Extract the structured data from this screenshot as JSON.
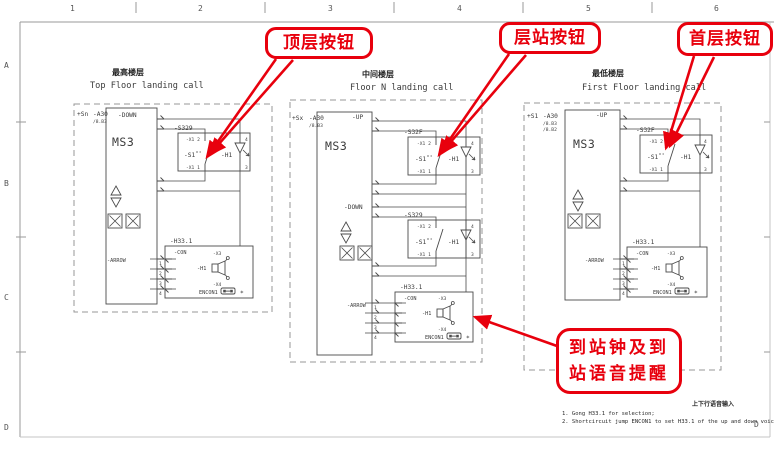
{
  "frame": {
    "cols": [
      "1",
      "2",
      "3",
      "4",
      "5",
      "6"
    ],
    "rowA": "A",
    "rowB": "B",
    "rowC": "C",
    "rowD": "D",
    "rowD_right": "D"
  },
  "callouts": {
    "top": "顶层按钮",
    "middle": "层站按钮",
    "first": "首层按钮",
    "arrival_l1": "到站钟及到",
    "arrival_l2": "站语音提醒"
  },
  "panels": {
    "p1": {
      "cn": "最高楼层",
      "en": "Top Floor landing call",
      "section": "+Sn",
      "device": "-A30",
      "ref1": "/8.B3",
      "mcu": "MS3",
      "b1": {
        "dir": "-DOWN",
        "unit": "-S329",
        "sw": "-S1",
        "lamp": "-H1",
        "tl": "-X1 2",
        "bl": "-X1 1",
        "tr": "4",
        "br": "3"
      },
      "g": {
        "unit": "-H33.1",
        "con": "-CON",
        "arrow": "-ARROW",
        "n1": "1",
        "n2": "2",
        "n3": "3",
        "n4": "4",
        "amp": "-H1",
        "xt": "-X3",
        "xb": "-X4",
        "jp": "ENCON1",
        "star": "*"
      }
    },
    "p2": {
      "cn": "中间楼层",
      "en": "Floor N landing call",
      "section": "+Sx",
      "device": "-A30",
      "ref1": "/8.B3",
      "mcu": "MS3",
      "b1": {
        "dir": "-UP",
        "unit": "-S32F",
        "sw": "-S1",
        "lamp": "-H1",
        "tl": "-X1 2",
        "bl": "-X1 1",
        "tr": "4",
        "br": "3"
      },
      "b2": {
        "dir": "-DOWN",
        "unit": "-S329",
        "sw": "-S1",
        "lamp": "-H1",
        "tl": "-X1 2",
        "bl": "-X1 1",
        "tr": "4",
        "br": "3"
      },
      "g": {
        "unit": "-H33.1",
        "con": "-CON",
        "arrow": "-ARROW",
        "n1": "1",
        "n2": "2",
        "n3": "3",
        "n4": "4",
        "amp": "-H1",
        "xt": "-X3",
        "xb": "-X4",
        "jp": "ENCON1",
        "star": "*"
      }
    },
    "p3": {
      "cn": "最低楼层",
      "en": "First Floor landing call",
      "section": "+S1",
      "device": "-A30",
      "ref1": "/8.B3",
      "ref2": "/8.B2",
      "mcu": "MS3",
      "b1": {
        "dir": "-UP",
        "unit": "-S32F",
        "sw": "-S1",
        "lamp": "-H1",
        "tl": "-X1 2",
        "bl": "-X1 1",
        "tr": "4",
        "br": "3"
      },
      "g": {
        "unit": "-H33.1",
        "con": "-CON",
        "arrow": "-ARROW",
        "n1": "1",
        "n2": "2",
        "n3": "3",
        "n4": "4",
        "amp": "-H1",
        "xt": "-X3",
        "xb": "-X4",
        "jp": "ENCON1",
        "star": "*"
      }
    }
  },
  "notes": {
    "cn": "上下行语音输入",
    "n1": "1. Gong H33.1 for selection;",
    "n2": "2. Shortcircuit jump ENCON1 to set H33.1 of the up and down voice input"
  }
}
